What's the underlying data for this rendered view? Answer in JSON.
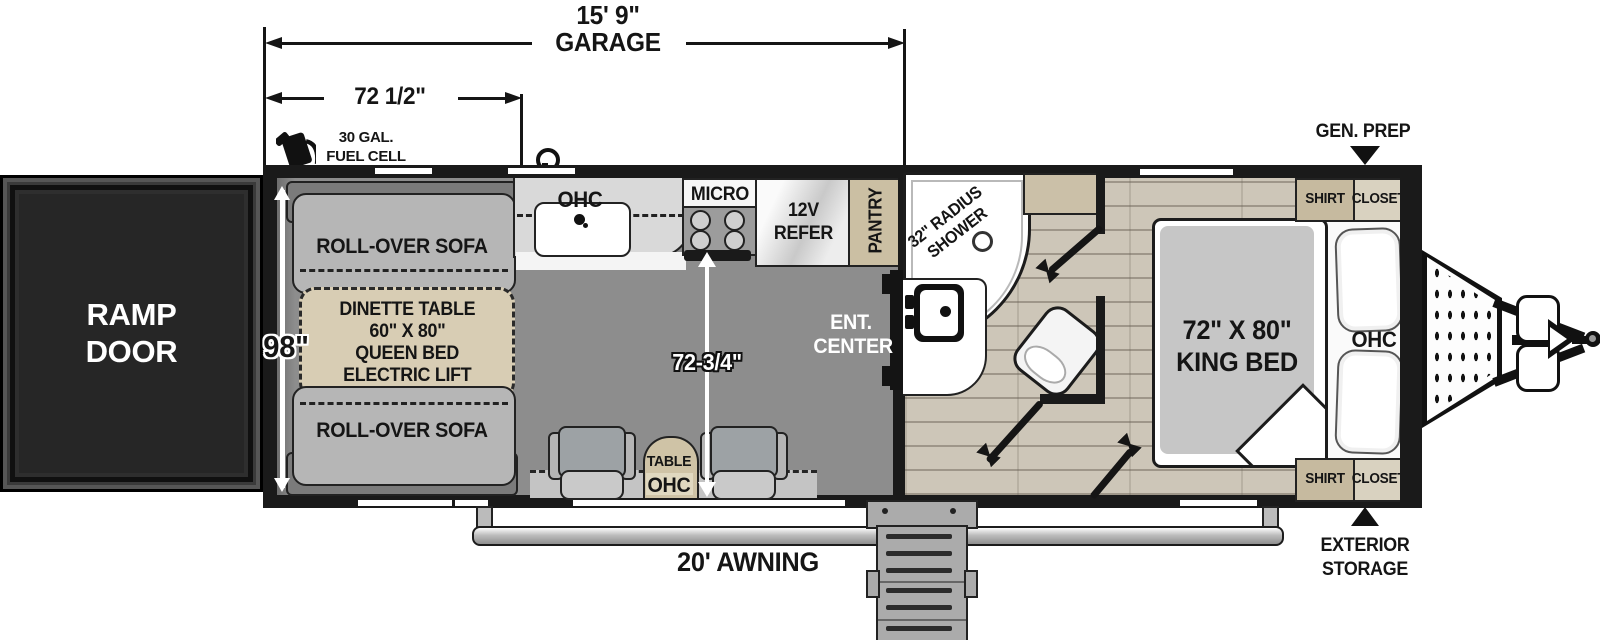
{
  "dimensions": {
    "garage_length_line1": "15' 9\"",
    "garage_length_line2": "GARAGE",
    "garage_width": "72 1/2\"",
    "body_width": "98\"",
    "garage_interior_length": "72-3/4\"",
    "awning": "20' AWNING"
  },
  "exterior": {
    "fuel_line1": "30 GAL.",
    "fuel_line2": "FUEL CELL",
    "gen_prep": "GEN. PREP",
    "storage_line1": "EXTERIOR",
    "storage_line2": "STORAGE"
  },
  "garage": {
    "ramp_line1": "RAMP",
    "ramp_line2": "DOOR",
    "sofa_top": "ROLL-OVER SOFA",
    "sofa_bottom": "ROLL-OVER SOFA",
    "dinette": [
      "DINETTE TABLE",
      "60\" X 80\"",
      "QUEEN BED",
      "ELECTRIC LIFT"
    ],
    "kitchen_ohc": "OHC",
    "micro": "MICRO",
    "refer_line1": "12V",
    "refer_line2": "REFER",
    "pantry": "PANTRY",
    "ent_line1": "ENT.",
    "ent_line2": "CENTER",
    "table": "TABLE",
    "table_ohc": "OHC"
  },
  "bathroom": {
    "shower_line1": "32\" RADIUS",
    "shower_line2": "SHOWER"
  },
  "bedroom": {
    "bed_line1": "72\" X 80\"",
    "bed_line2": "KING BED",
    "ohc": "OHC",
    "closet_top_left": "SHIRT",
    "closet_top_right": "CLOSET",
    "closet_bottom_left": "SHIRT",
    "closet_bottom_right": "CLOSET"
  },
  "colors": {
    "wall": "#1a1a1a",
    "garage_floor": "#8d8d8d",
    "wood_floor": "#cdc6b8",
    "tan": "#cbbfa3",
    "tan_light": "#d9d2c0",
    "dinette": "#d8cdb4",
    "sofa": "#b5b5b5",
    "bed": "#c6c6c6",
    "ramp_door": "#262626"
  }
}
